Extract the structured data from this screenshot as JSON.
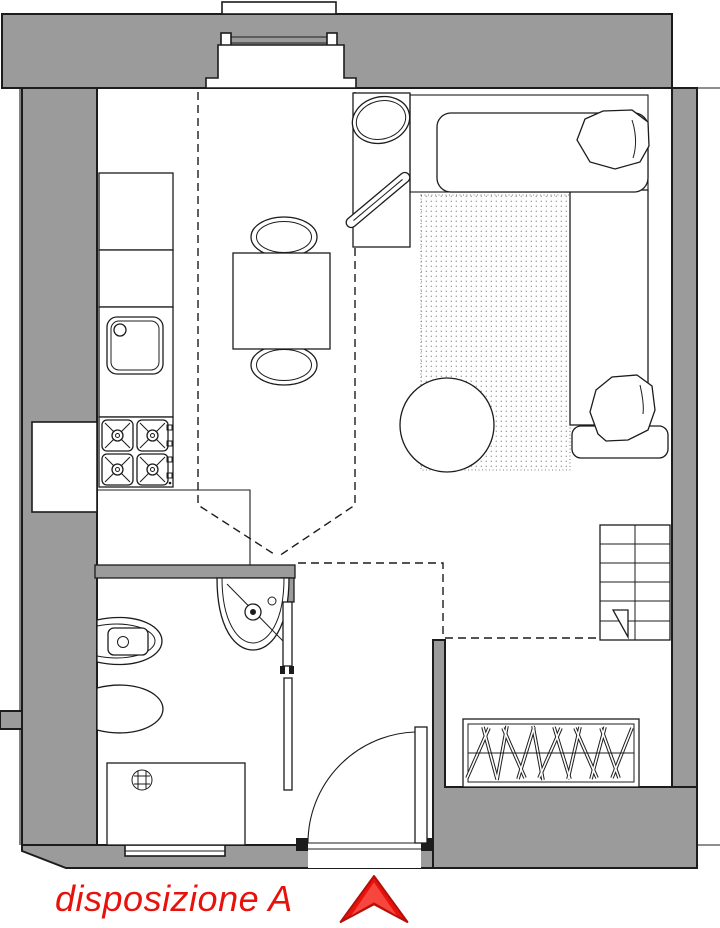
{
  "caption": {
    "title": "disposizione A"
  },
  "colors": {
    "wall": "#9b9b9b",
    "line": "#1c1c1c",
    "accent": "#e8120d",
    "background": "#ffffff",
    "stipple": "#8f8f8f"
  },
  "plan_symbols": [
    "balcony-window",
    "kitchen-cabinets",
    "kitchen-sink",
    "gas-stove",
    "dining-table",
    "dining-chairs",
    "storage-cabinet",
    "sofa",
    "bed",
    "rug",
    "round-pouf",
    "pillows",
    "staircase",
    "wardrobe-rail",
    "corner-washbasin",
    "bidet",
    "toilet",
    "shower-tray",
    "sliding-door",
    "entry-door",
    "north-arrow"
  ]
}
